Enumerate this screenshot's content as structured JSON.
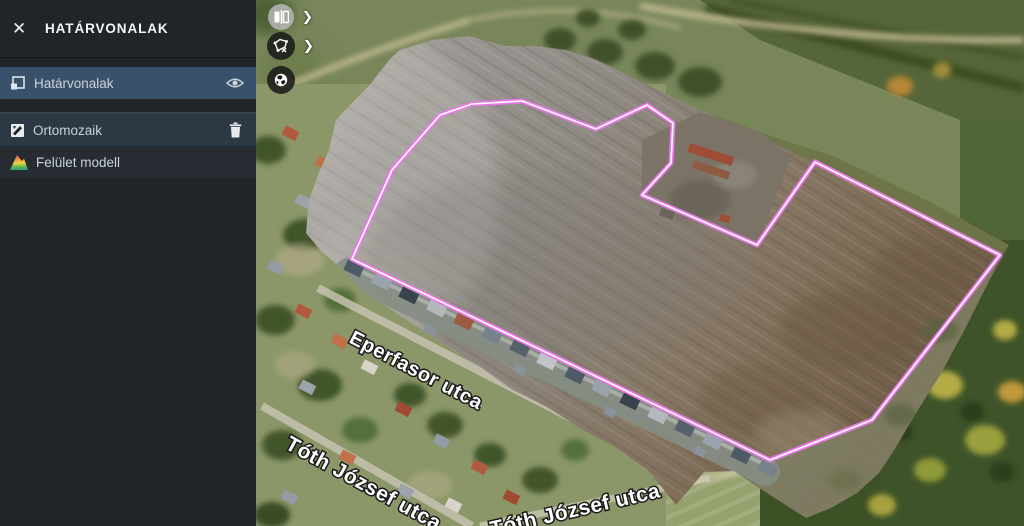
{
  "sidebar": {
    "title": "HATÁRVONALAK",
    "close_glyph": "✕",
    "layers": [
      {
        "label": "Határvonalak"
      },
      {
        "label": "Ortomozaik"
      },
      {
        "label": "Felület modell"
      }
    ]
  },
  "toolbar": {
    "chevron": "❯"
  },
  "map": {
    "street_labels": [
      {
        "text": "Eperfasor utca"
      },
      {
        "text": "Tóth József utca"
      },
      {
        "text": "Tóth József utca"
      }
    ],
    "boundary": {
      "color": "#ef76ef",
      "inner_color": "#ffffff",
      "points": "352,259 392,170 440,115 472,104 522,101 596,129 647,105 673,123 671,163 642,195 757,245 815,162 1000,255 872,420 770,460"
    }
  },
  "colors": {
    "sidebar_bg": "#20252a",
    "selected_row": "#3a516b"
  }
}
